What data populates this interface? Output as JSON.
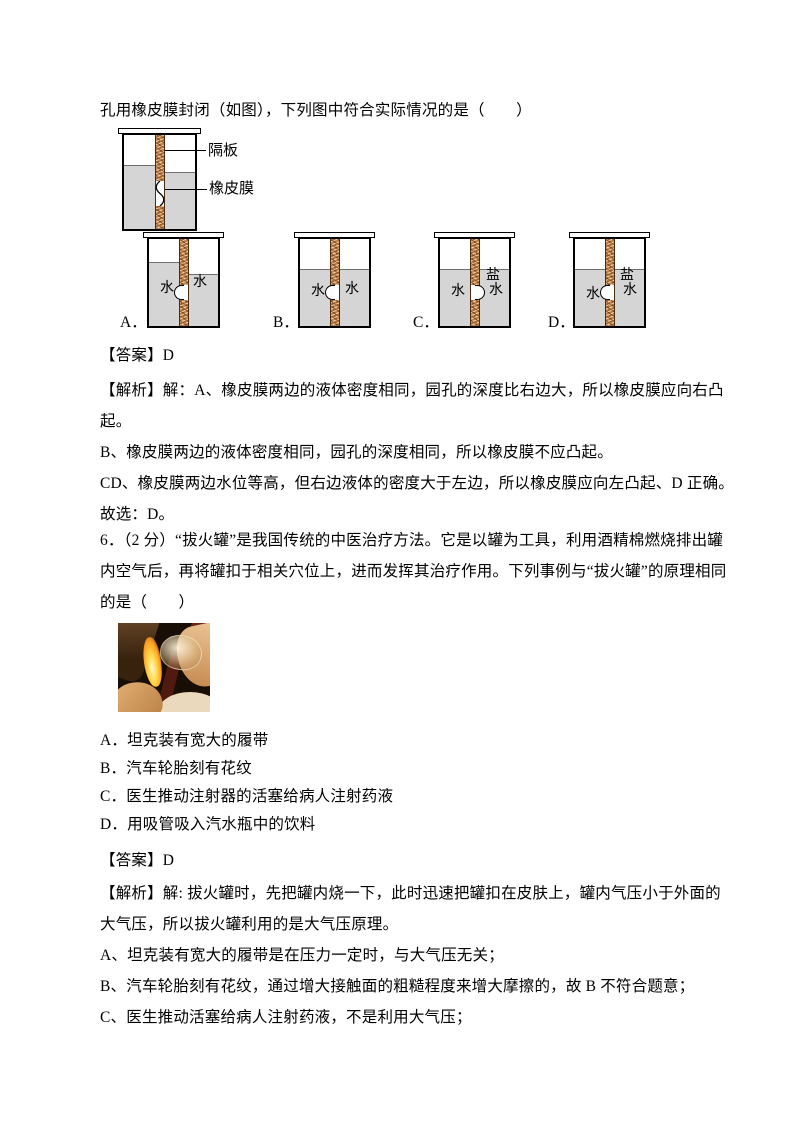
{
  "q5": {
    "stem": "孔用橡皮膜封闭（如图），下列图中符合实际情况的是（　　）",
    "figure": {
      "label_divider": "隔板",
      "label_membrane": "橡皮膜"
    },
    "options": [
      {
        "letter": "A．",
        "left_liquid": "水",
        "right_liquid_top": "水",
        "right_liquid_bottom": ""
      },
      {
        "letter": "B．",
        "left_liquid": "水",
        "right_liquid_top": "水",
        "right_liquid_bottom": ""
      },
      {
        "letter": "C．",
        "left_liquid": "水",
        "right_liquid_top": "盐",
        "right_liquid_bottom": "水"
      },
      {
        "letter": "D．",
        "left_liquid": "水",
        "right_liquid_top": "盐",
        "right_liquid_bottom": "水"
      }
    ],
    "answer_line": "【答案】D",
    "analysis": [
      "【解析】解：A、橡皮膜两边的液体密度相同，园孔的深度比右边大，所以橡皮膜应向右凸",
      "起。",
      "B、橡皮膜两边的液体密度相同，园孔的深度相同，所以橡皮膜不应凸起。",
      "CD、橡皮膜两边水位等高，但右边液体的密度大于左边，所以橡皮膜应向左凸起、D 正确。",
      "故选：D。"
    ]
  },
  "q6": {
    "stem_lines": [
      "6．（2 分）“拔火罐”是我国传统的中医治疗方法。它是以罐为工具，利用酒精棉燃烧排出罐",
      "内空气后，再将罐扣于相关穴位上，进而发挥其治疗作用。下列事例与“拔火罐”的原理相同",
      "的是（　　）"
    ],
    "options": [
      "A．坦克装有宽大的履带",
      "B．汽车轮胎刻有花纹",
      "C．医生推动注射器的活塞给病人注射药液",
      "D．用吸管吸入汽水瓶中的饮料"
    ],
    "answer_line": "【答案】D",
    "analysis": [
      "【解析】解: 拔火罐时，先把罐内烧一下，此时迅速把罐扣在皮肤上，罐内气压小于外面的",
      "大气压，所以拔火罐利用的是大气压原理。",
      "A、坦克装有宽大的履带是在压力一定时，与大气压无关；",
      "B、汽车轮胎刻有花纹，通过增大接触面的粗糙程度来增大摩擦的，故 B 不符合题意；",
      "C、医生推动活塞给病人注射药液，不是利用大气压；"
    ]
  },
  "colors": {
    "liquid_gray": "#d5d5d5",
    "divider_brown": "#c08048",
    "flame_yellow": "#ffd84d",
    "photo_background": "#190e05",
    "text": "#000000",
    "page_background": "#ffffff"
  }
}
